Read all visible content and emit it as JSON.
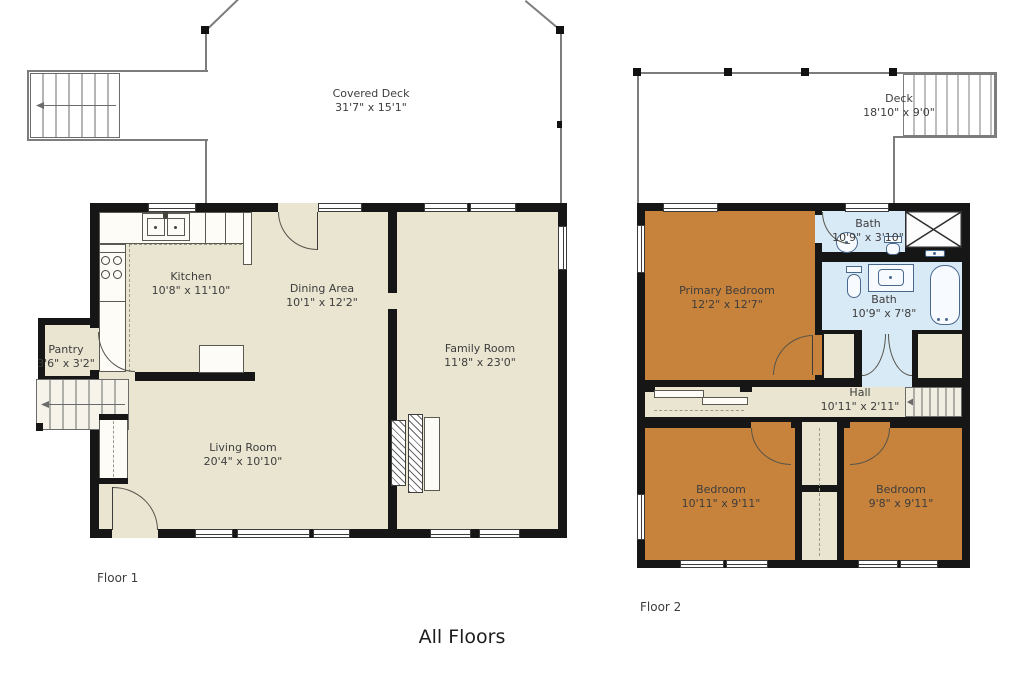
{
  "title": "All Floors",
  "palette": {
    "floor_fill": "#e9e5d1",
    "bedroom_fill": "#c7823b",
    "bath_fill": "#d9eaf7",
    "wall_color": "#161616"
  },
  "floor1": {
    "label": "Floor 1",
    "deck": {
      "name": "Covered Deck",
      "dims": "31'7\" x 15'1\""
    },
    "rooms": {
      "kitchen": {
        "name": "Kitchen",
        "dims": "10'8\" x 11'10\""
      },
      "dining": {
        "name": "Dining Area",
        "dims": "10'1\" x 12'2\""
      },
      "family": {
        "name": "Family Room",
        "dims": "11'8\" x 23'0\""
      },
      "pantry": {
        "name": "Pantry",
        "dims": "3'6\" x 3'2\""
      },
      "living": {
        "name": "Living Room",
        "dims": "20'4\" x 10'10\""
      }
    }
  },
  "floor2": {
    "label": "Floor 2",
    "deck": {
      "name": "Deck",
      "dims": "18'10\" x 9'0\""
    },
    "rooms": {
      "primary_bedroom": {
        "name": "Primary Bedroom",
        "dims": "12'2\" x 12'7\""
      },
      "bath_upper": {
        "name": "Bath",
        "dims": "10'9\" x 3'10\""
      },
      "bath_lower": {
        "name": "Bath",
        "dims": "10'9\" x 7'8\""
      },
      "hall": {
        "name": "Hall",
        "dims": "10'11\" x 2'11\""
      },
      "bedroom_left": {
        "name": "Bedroom",
        "dims": "10'11\" x 9'11\""
      },
      "bedroom_right": {
        "name": "Bedroom",
        "dims": "9'8\" x 9'11\""
      }
    }
  }
}
